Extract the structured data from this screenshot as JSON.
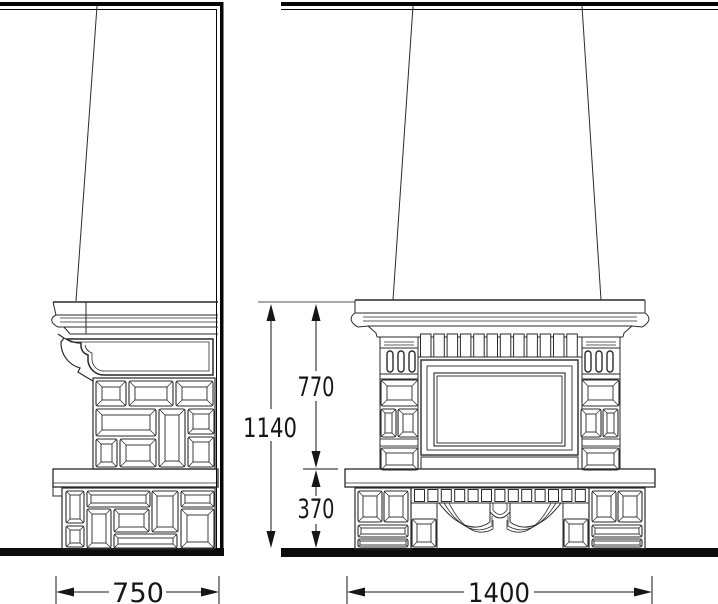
{
  "dimensions": {
    "side_depth_label": "750",
    "front_width_label": "1400",
    "overall_height_label": "1140",
    "upper_height_label": "770",
    "base_height_label": "370"
  },
  "drawing": {
    "colors": {
      "line": "#2a2a2a",
      "heavy": "#050505",
      "bg": "#ffffff"
    },
    "side_view": {
      "body_panels": [
        [
          96,
          381,
          30,
          25,
          6
        ],
        [
          129,
          381,
          44,
          25,
          6
        ],
        [
          176,
          381,
          37,
          25,
          6
        ],
        [
          96,
          409,
          60,
          27,
          6
        ],
        [
          159,
          409,
          26,
          58,
          6
        ],
        [
          188,
          409,
          26,
          25,
          5
        ],
        [
          96,
          439,
          21,
          28,
          5
        ],
        [
          120,
          439,
          36,
          28,
          6
        ],
        [
          188,
          437,
          26,
          30,
          5
        ]
      ],
      "base_panels": [
        [
          66,
          491,
          18,
          32,
          4
        ],
        [
          66,
          526,
          18,
          21,
          4
        ],
        [
          87,
          491,
          63,
          16,
          4
        ],
        [
          152,
          491,
          26,
          41,
          5
        ],
        [
          181,
          491,
          33,
          16,
          4
        ],
        [
          87,
          509,
          24,
          39,
          5
        ],
        [
          114,
          509,
          35,
          23,
          5
        ],
        [
          114,
          534,
          63,
          14,
          4
        ],
        [
          181,
          509,
          33,
          39,
          6
        ]
      ]
    },
    "front_view": {
      "column_panels": [
        [
          381,
          380,
          37,
          26,
          6
        ],
        [
          381,
          409,
          15,
          28,
          4
        ],
        [
          398,
          409,
          20,
          28,
          5
        ],
        [
          381,
          448,
          37,
          22,
          5
        ],
        [
          582,
          380,
          37,
          26,
          6
        ],
        [
          581,
          409,
          20,
          28,
          5
        ],
        [
          603,
          409,
          15,
          28,
          4
        ],
        [
          582,
          448,
          37,
          22,
          5
        ]
      ],
      "leg_panels": [
        [
          358,
          491,
          24,
          31,
          5
        ],
        [
          384,
          491,
          24,
          31,
          5
        ],
        [
          358,
          525,
          50,
          12,
          3
        ],
        [
          358,
          539,
          50,
          8,
          2
        ],
        [
          592,
          491,
          24,
          31,
          5
        ],
        [
          618,
          491,
          24,
          31,
          5
        ],
        [
          592,
          525,
          50,
          12,
          3
        ],
        [
          592,
          539,
          50,
          8,
          2
        ],
        [
          412,
          519,
          24,
          28,
          5
        ],
        [
          564,
          519,
          24,
          28,
          5
        ]
      ],
      "dentils_frieze": {
        "x": 420.5,
        "y": 334,
        "w": 10.5,
        "h": 23,
        "count": 12,
        "pitch": 13.3
      },
      "dentils_apron": {
        "x": 414.5,
        "y": 489.5,
        "w": 10,
        "h": 12,
        "count": 13,
        "pitch": 13.4
      },
      "slots": {
        "cx": [
          390,
          401,
          412,
          588,
          599,
          610
        ],
        "y": 351,
        "w": 6,
        "h": 21
      }
    }
  }
}
